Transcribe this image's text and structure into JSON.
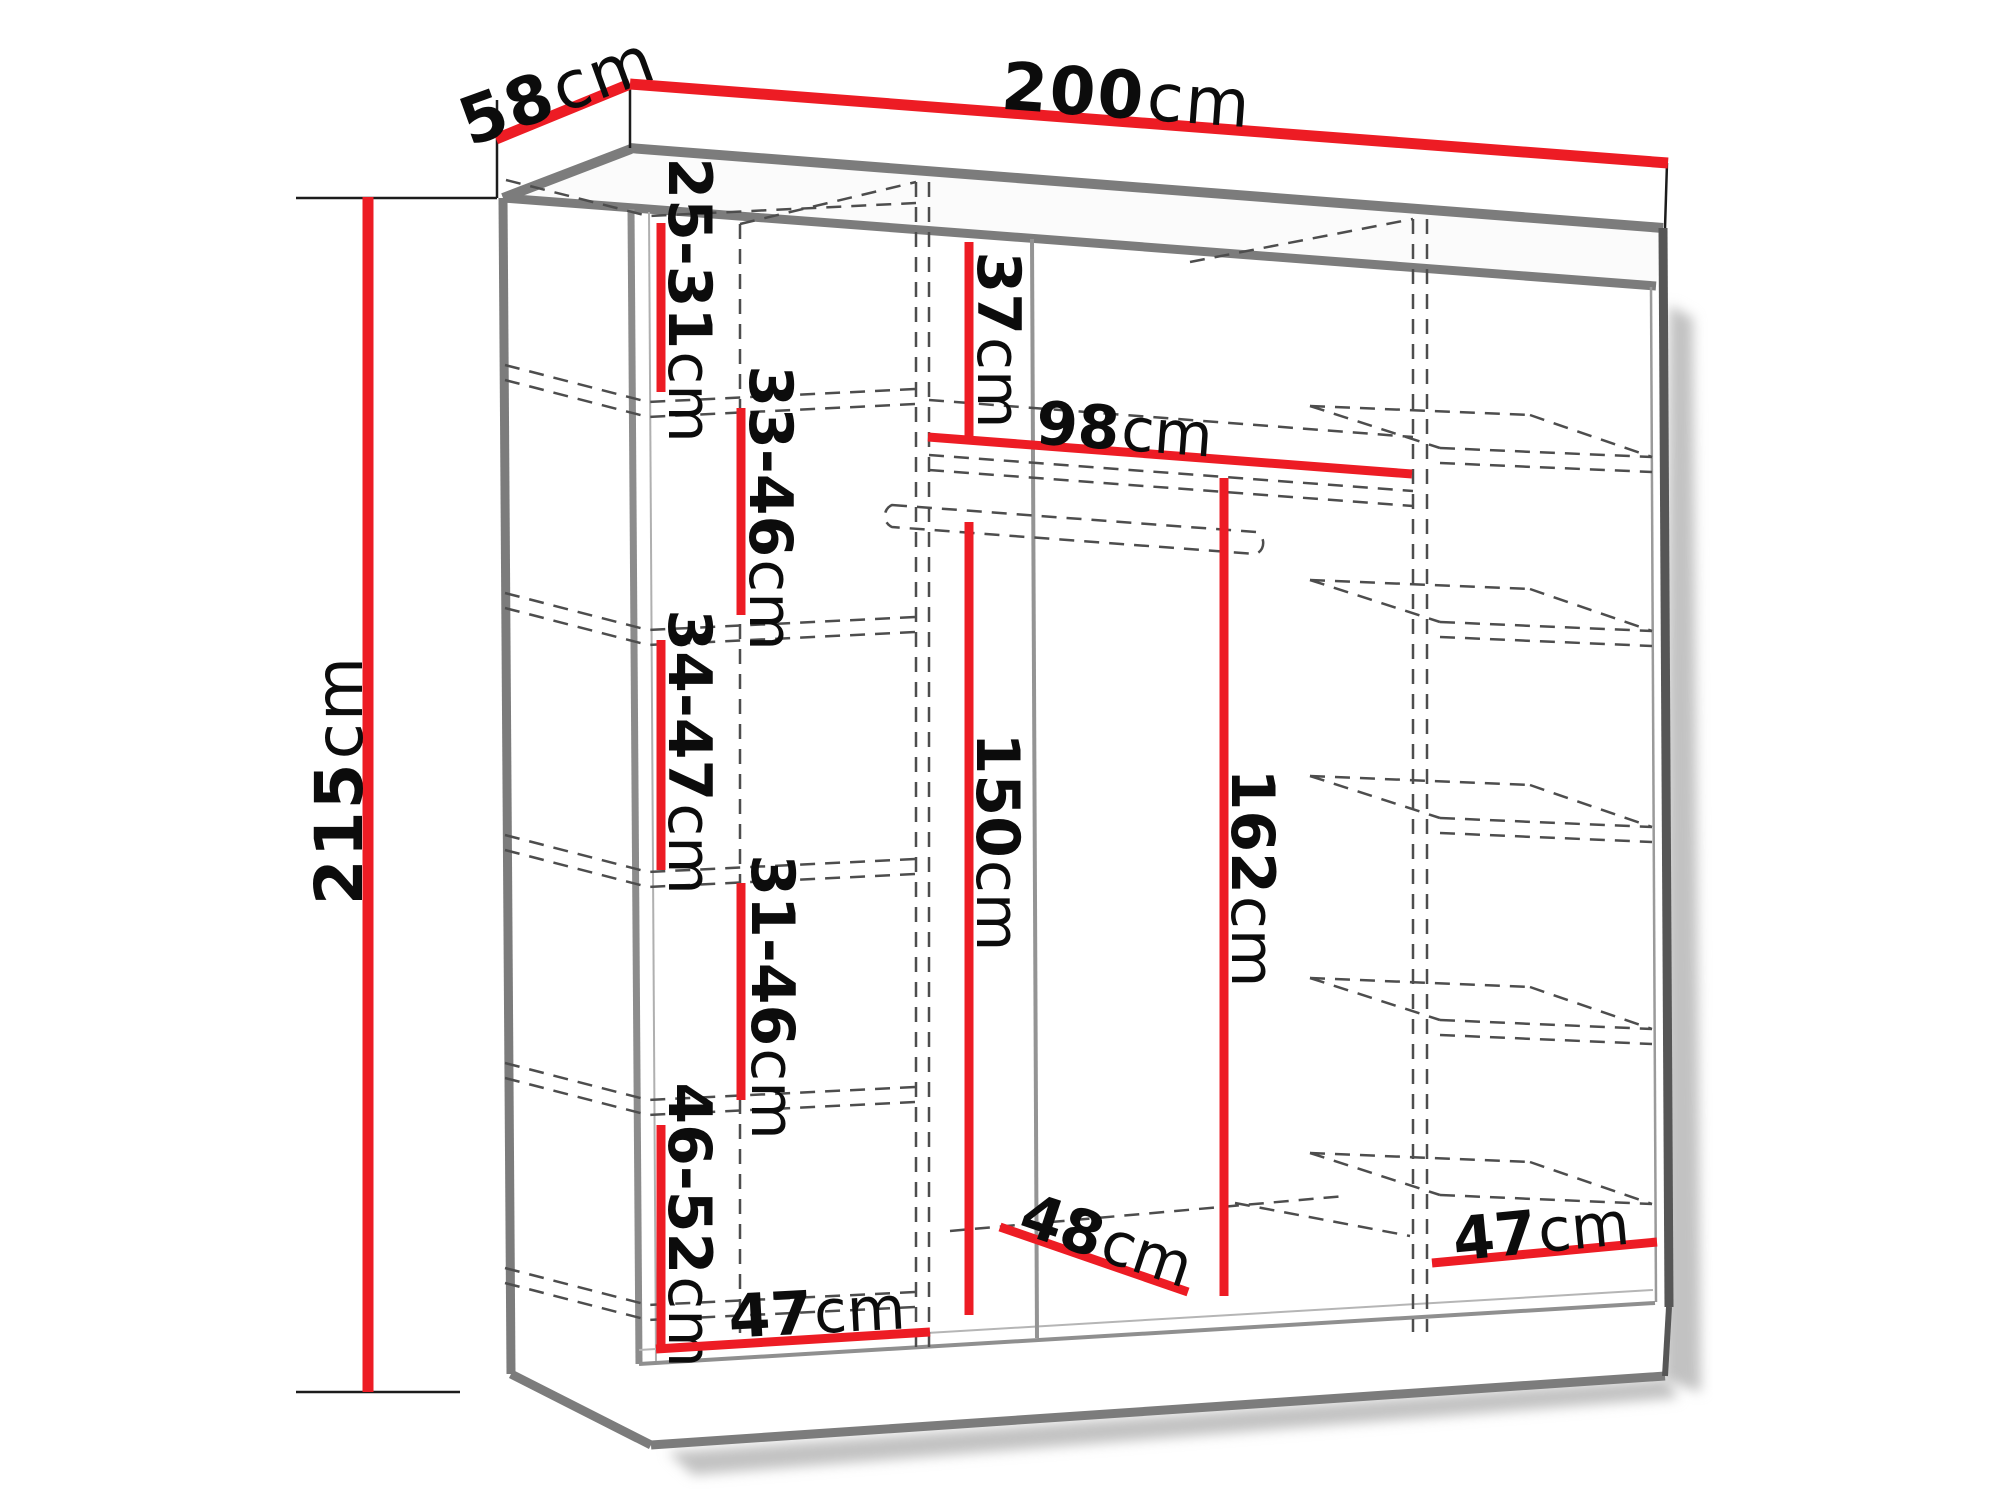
{
  "colors": {
    "dimension_line": "#ed1c24",
    "structure_edge": "#7c7c7c",
    "hidden_line": "#4d4d4d",
    "label_text": "#0c0c0c",
    "shadow": "#c2c2c2",
    "background": "#ffffff"
  },
  "dimensions": {
    "overall": {
      "width": {
        "value": "200",
        "unit": "cm"
      },
      "depth": {
        "value": "58",
        "unit": "cm"
      },
      "height": {
        "value": "215",
        "unit": "cm"
      }
    },
    "left_column": {
      "gap1": {
        "value": "25-31",
        "unit": "cm"
      },
      "gap2": {
        "value": "33-46",
        "unit": "cm"
      },
      "gap3": {
        "value": "34-47",
        "unit": "cm"
      },
      "gap4": {
        "value": "31-46",
        "unit": "cm"
      },
      "gap5": {
        "value": "46-52",
        "unit": "cm"
      },
      "width": {
        "value": "47",
        "unit": "cm"
      }
    },
    "middle_column": {
      "top_gap": {
        "value": "37",
        "unit": "cm"
      },
      "rail_width": {
        "value": "98",
        "unit": "cm"
      },
      "hanging_height": {
        "value": "150",
        "unit": "cm"
      },
      "full_height": {
        "value": "162",
        "unit": "cm"
      },
      "depth": {
        "value": "48",
        "unit": "cm"
      }
    },
    "right_column": {
      "width": {
        "value": "47",
        "unit": "cm"
      }
    }
  }
}
